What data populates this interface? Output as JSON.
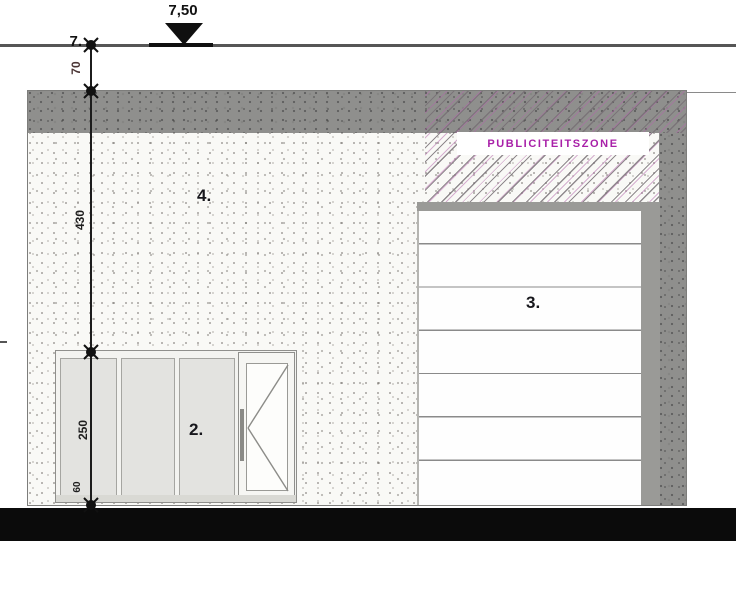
{
  "level": {
    "value": "7,50",
    "edge_label": "7."
  },
  "dimensions": {
    "parapet": "70",
    "upper_wall": "430",
    "storefront_height": "250",
    "plinth": "60"
  },
  "part_labels": {
    "wall": "4.",
    "storefront": "2.",
    "sectional_door": "3."
  },
  "publicity_zone": {
    "label": "PUBLICITEITSZONE"
  },
  "colors": {
    "band_gray": "#8f8f8d",
    "wall_offwhite": "#f9f9f6",
    "hatch_magenta": "#b266aa",
    "publicity_text": "#a820a8",
    "glass_gray": "#e3e3e0",
    "ground_black": "#0b0b0b"
  }
}
